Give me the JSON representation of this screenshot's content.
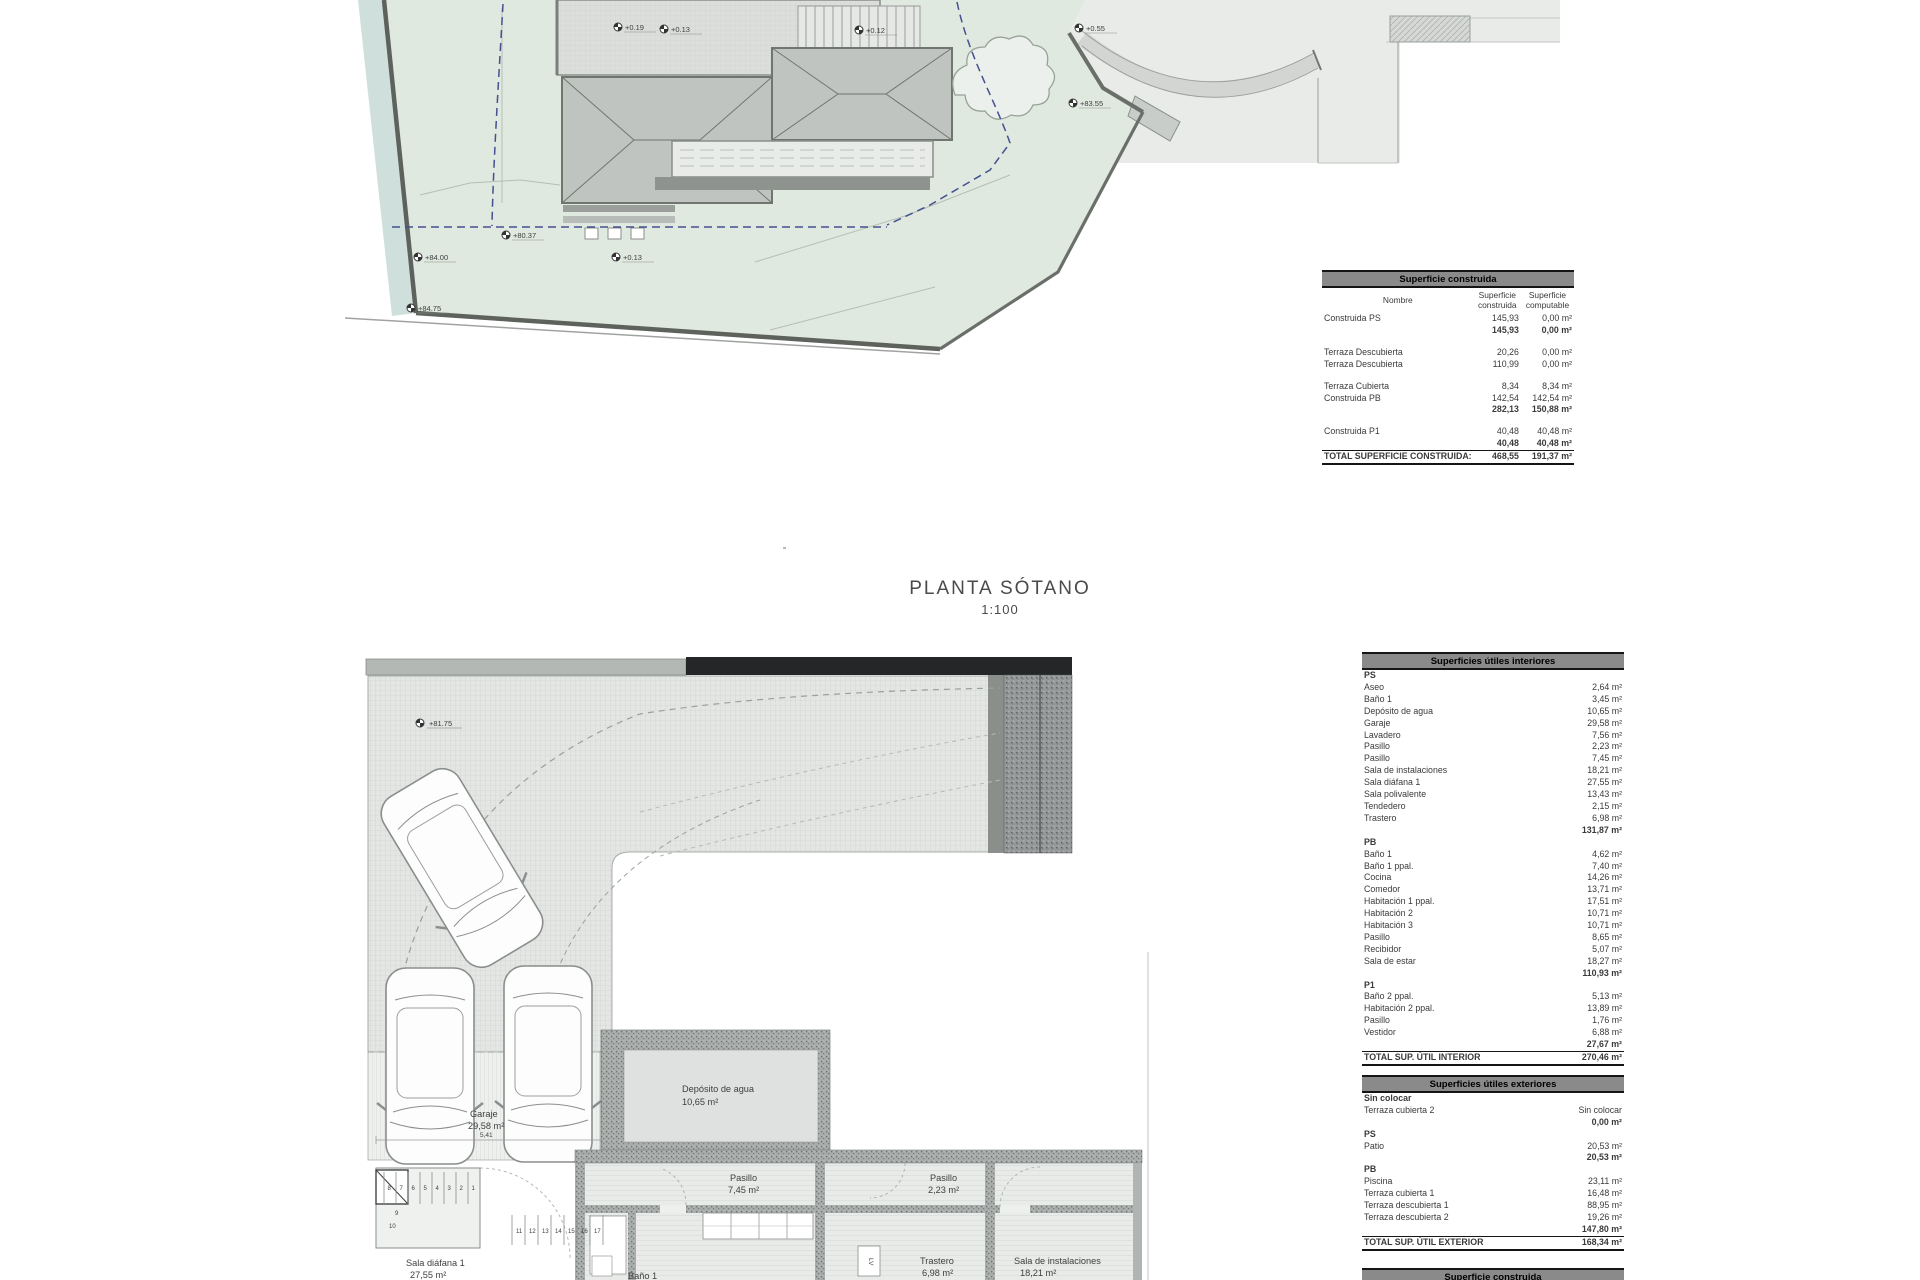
{
  "drawing": {
    "title": "PLANTA SÓTANO",
    "scale": "1:100"
  },
  "colors": {
    "plot_green": "#e0e9e0",
    "water": "#cfdfdb",
    "road": "#e9ebe9",
    "roof": "#c0c4c0",
    "table_header": "#8a8a8a",
    "setback_blue": "#44518f"
  },
  "site_plan": {
    "markers": [
      {
        "label": "+0.19"
      },
      {
        "label": "+0.13"
      },
      {
        "label": "+0.12"
      },
      {
        "label": "+0.55"
      },
      {
        "label": "+83.55"
      },
      {
        "label": "+0.13"
      },
      {
        "label": "+80.37"
      },
      {
        "label": "+84.00"
      },
      {
        "label": "+84.75"
      }
    ]
  },
  "basement_plan": {
    "marker": "+81.75",
    "rooms": [
      {
        "name": "Garaje",
        "area": "29,58 m²"
      },
      {
        "name": "Depósito de agua",
        "area": "10,65 m²"
      },
      {
        "name": "Pasillo",
        "area": "7,45 m²"
      },
      {
        "name": "Pasillo",
        "area": "2,23 m²"
      },
      {
        "name": "Trastero",
        "area": "6,98 m²"
      },
      {
        "name": "Sala de instalaciones",
        "area": "18,21 m²"
      },
      {
        "name": "Sala diáfana 1",
        "area": "27,55 m²"
      },
      {
        "name": "Baño 1",
        "area": ""
      }
    ],
    "stair_numbers_upper": [
      "8",
      "7",
      "6",
      "5",
      "4",
      "3",
      "2",
      "1"
    ],
    "stair_mid": [
      "9",
      "10"
    ],
    "stair_numbers_lower": [
      "11",
      "12",
      "13",
      "14",
      "15",
      "16",
      "17"
    ],
    "dims": [
      "5,41",
      "5,20",
      "2,84",
      "7,46"
    ],
    "appliance": "LV"
  },
  "tables": {
    "construida": {
      "title": "Superficie construida",
      "headers": [
        "Nombre",
        "Superficie construida",
        "Superficie computable"
      ],
      "rows": [
        {
          "n": "Construida PS",
          "a": "145,93",
          "b": "0,00 m²",
          "k": "item"
        },
        {
          "n": "",
          "a": "145,93",
          "b": "0,00 m²",
          "k": "sub"
        },
        {
          "k": "spacer"
        },
        {
          "n": "Terraza Descubierta",
          "a": "20,26",
          "b": "0,00 m²",
          "k": "item"
        },
        {
          "n": "Terraza Descubierta",
          "a": "110,99",
          "b": "0,00 m²",
          "k": "item"
        },
        {
          "k": "spacer"
        },
        {
          "n": "Terraza Cubierta",
          "a": "8,34",
          "b": "8,34 m²",
          "k": "item"
        },
        {
          "n": "Construida PB",
          "a": "142,54",
          "b": "142,54 m²",
          "k": "item"
        },
        {
          "n": "",
          "a": "282,13",
          "b": "150,88 m²",
          "k": "sub"
        },
        {
          "k": "spacer"
        },
        {
          "n": "Construida P1",
          "a": "40,48",
          "b": "40,48 m²",
          "k": "item"
        },
        {
          "n": "",
          "a": "40,48",
          "b": "40,48 m²",
          "k": "sub"
        },
        {
          "n": "TOTAL SUPERFICIE CONSTRUIDA:",
          "a": "468,55",
          "b": "191,37 m²",
          "k": "total"
        }
      ]
    },
    "interiores": {
      "title": "Superficies útiles interiores",
      "rows": [
        {
          "t": "PS",
          "k": "section"
        },
        {
          "t": "Aseo",
          "v": "2,64 m²",
          "k": "item"
        },
        {
          "t": "Baño 1",
          "v": "3,45 m²",
          "k": "item"
        },
        {
          "t": "Depósito de agua",
          "v": "10,65 m²",
          "k": "item"
        },
        {
          "t": "Garaje",
          "v": "29,58 m²",
          "k": "item"
        },
        {
          "t": "Lavadero",
          "v": "7,56 m²",
          "k": "item"
        },
        {
          "t": "Pasillo",
          "v": "2,23 m²",
          "k": "item"
        },
        {
          "t": "Pasillo",
          "v": "7,45 m²",
          "k": "item"
        },
        {
          "t": "Sala de instalaciones",
          "v": "18,21 m²",
          "k": "item"
        },
        {
          "t": "Sala diáfana 1",
          "v": "27,55 m²",
          "k": "item"
        },
        {
          "t": "Sala polivalente",
          "v": "13,43 m²",
          "k": "item"
        },
        {
          "t": "Tendedero",
          "v": "2,15 m²",
          "k": "item"
        },
        {
          "t": "Trastero",
          "v": "6,98 m²",
          "k": "item"
        },
        {
          "t": "",
          "v": "131,87 m²",
          "k": "sub"
        },
        {
          "t": "PB",
          "k": "section"
        },
        {
          "t": "Baño 1",
          "v": "4,62 m²",
          "k": "item"
        },
        {
          "t": "Baño 1 ppal.",
          "v": "7,40 m²",
          "k": "item"
        },
        {
          "t": "Cocina",
          "v": "14,26 m²",
          "k": "item"
        },
        {
          "t": "Comedor",
          "v": "13,71 m²",
          "k": "item"
        },
        {
          "t": "Habitación 1 ppal.",
          "v": "17,51 m²",
          "k": "item"
        },
        {
          "t": "Habitación 2",
          "v": "10,71 m²",
          "k": "item"
        },
        {
          "t": "Habitación 3",
          "v": "10,71 m²",
          "k": "item"
        },
        {
          "t": "Pasillo",
          "v": "8,65 m²",
          "k": "item"
        },
        {
          "t": "Recibidor",
          "v": "5,07 m²",
          "k": "item"
        },
        {
          "t": "Sala de estar",
          "v": "18,27 m²",
          "k": "item"
        },
        {
          "t": "",
          "v": "110,93 m²",
          "k": "sub"
        },
        {
          "t": "P1",
          "k": "section"
        },
        {
          "t": "Baño 2 ppal.",
          "v": "5,13 m²",
          "k": "item"
        },
        {
          "t": "Habitación 2 ppal.",
          "v": "13,89 m²",
          "k": "item"
        },
        {
          "t": "Pasillo",
          "v": "1,76 m²",
          "k": "item"
        },
        {
          "t": "Vestidor",
          "v": "6,88 m²",
          "k": "item"
        },
        {
          "t": "",
          "v": "27,67 m²",
          "k": "sub"
        },
        {
          "t": "TOTAL SUP. ÚTIL INTERIOR",
          "v": "270,46 m²",
          "k": "total"
        }
      ]
    },
    "exteriores": {
      "title": "Superficies útiles exteriores",
      "rows": [
        {
          "t": "Sin colocar",
          "k": "section"
        },
        {
          "t": "Terraza cubierta 2",
          "v": "Sin colocar",
          "k": "item"
        },
        {
          "t": "",
          "v": "0,00 m²",
          "k": "sub"
        },
        {
          "t": "PS",
          "k": "section"
        },
        {
          "t": "Patio",
          "v": "20,53 m²",
          "k": "item"
        },
        {
          "t": "",
          "v": "20,53 m²",
          "k": "sub"
        },
        {
          "t": "PB",
          "k": "section"
        },
        {
          "t": "Piscina",
          "v": "23,11 m²",
          "k": "item"
        },
        {
          "t": "Terraza cubierta 1",
          "v": "16,48 m²",
          "k": "item"
        },
        {
          "t": "Terraza descubierta 1",
          "v": "88,95 m²",
          "k": "item"
        },
        {
          "t": "Terraza descubierta 2",
          "v": "19,26 m²",
          "k": "item"
        },
        {
          "t": "",
          "v": "147,80 m²",
          "k": "sub"
        },
        {
          "t": "TOTAL SUP. ÚTIL EXTERIOR",
          "v": "168,34 m²",
          "k": "total"
        }
      ]
    },
    "next_table_title": "Superficie construida"
  }
}
